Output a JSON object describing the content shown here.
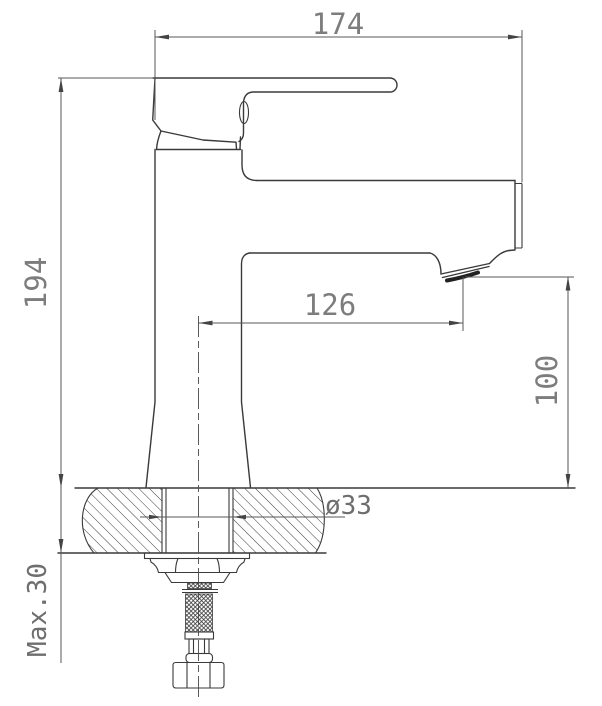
{
  "drawing": {
    "title": "faucet-installation-dimension-drawing",
    "subject": "Single-lever basin mixer faucet, side elevation with countertop mounting cross-section",
    "units": "mm",
    "background_color": "#ffffff",
    "line_color": "#3a3a3a",
    "dim_text_color": "#7d7d7d",
    "dimensions": {
      "overall_width": {
        "label": "174",
        "meaning": "overall width across handle and spout end"
      },
      "body_height": {
        "label": "194",
        "meaning": "total height above counter"
      },
      "spout_reach": {
        "label": "126",
        "meaning": "spout reach from faucet axis to aerator"
      },
      "outlet_height": {
        "label": "100",
        "meaning": "height from counter to aerator outlet"
      },
      "hole_diameter": {
        "label": "ø33",
        "meaning": "mounting hole diameter"
      },
      "max_thickness": {
        "label": "Max.30",
        "meaning": "maximum countertop thickness"
      }
    },
    "parts": [
      "handle-lever",
      "cartridge-collar",
      "faucet-body",
      "spout",
      "spout-end-cap",
      "aerator",
      "countertop-section",
      "threaded-shank",
      "washer-plate",
      "mounting-nut",
      "braided-supply-hose",
      "hose-end-nut"
    ]
  }
}
